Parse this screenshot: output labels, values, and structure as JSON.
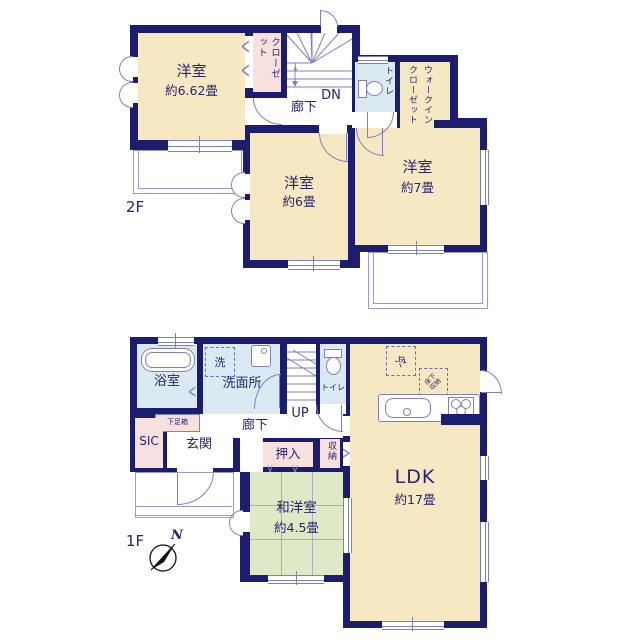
{
  "colors": {
    "wall": "#1d1d70",
    "western_room": "#f6e8c2",
    "closet_pink": "#f7e0dd",
    "wet_area_blue": "#dbe9f3",
    "tatami_green": "#dfe9c7",
    "fixture_line": "#8080bc",
    "text": "#26266e"
  },
  "floor2": {
    "floor_label": "2F",
    "room_662": {
      "name": "洋室",
      "size": "約6.62畳"
    },
    "closet_label": "クローゼット",
    "stairs_label": "DN",
    "hallway_label": "廊下",
    "toilet_label": "トイレ",
    "wic_label": "ウォークインクローゼット",
    "room_6": {
      "name": "洋室",
      "size": "約6畳"
    },
    "room_7": {
      "name": "洋室",
      "size": "約7畳"
    }
  },
  "floor1": {
    "floor_label": "1F",
    "compass_label": "N",
    "bath_label": "浴室",
    "washer_label": "洗",
    "washroom_label": "洗面所",
    "stairs_label": "UP",
    "toilet_label": "トイレ",
    "fridge_label": "冷",
    "underfloor_label": "床下収納",
    "shoebox_label": "下足箱",
    "sic_label": "SIC",
    "entrance_label": "玄関",
    "hallway_label": "廊下",
    "oshiire_label": "押入",
    "storage_label": "収納",
    "washitsu": {
      "name": "和洋室",
      "size": "約4.5畳"
    },
    "ldk": {
      "name": "LDK",
      "size": "約17畳"
    }
  },
  "symbols": {
    "bifold": "<",
    "fold_door": "<",
    "hinge_door": ">",
    "futon_mark": "∨",
    "down_arrow": "↓"
  }
}
